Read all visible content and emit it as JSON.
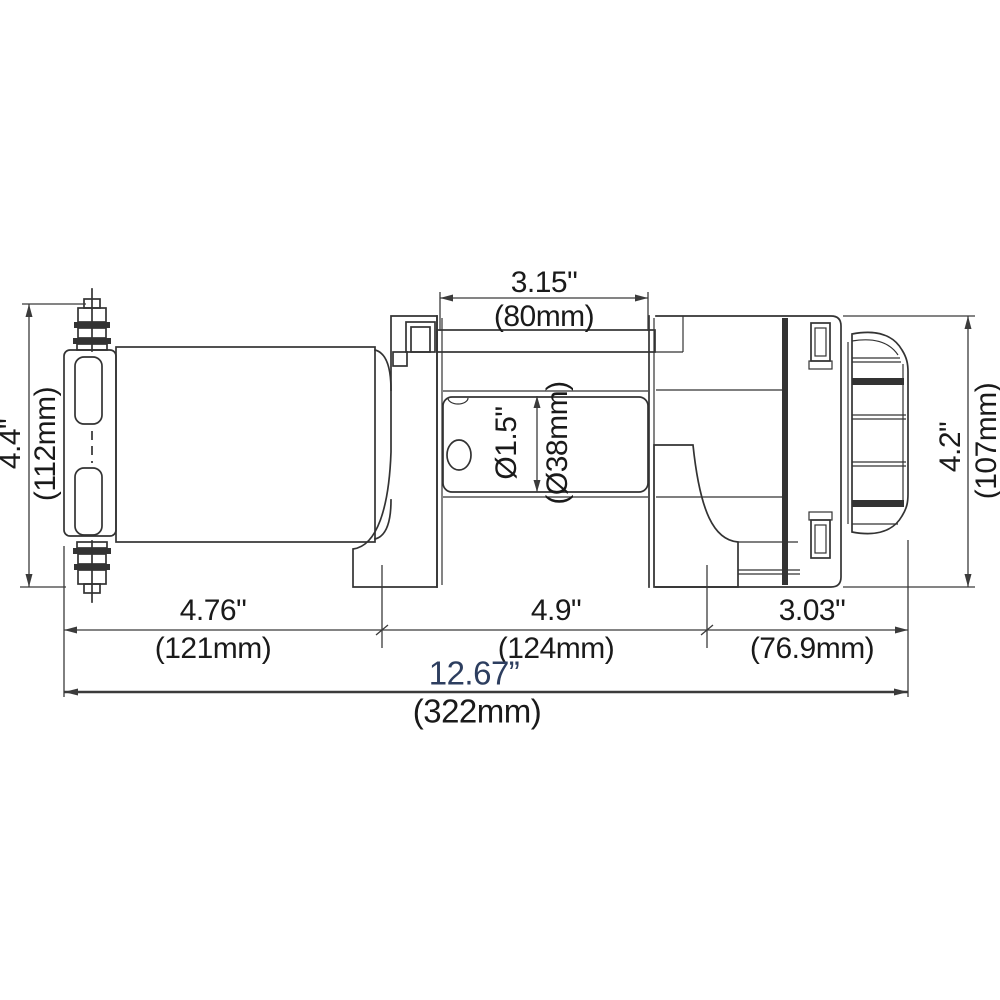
{
  "drawing": {
    "type": "technical-dimension-diagram",
    "subject": "electric winch side elevation",
    "dimensions": {
      "drum_width": {
        "in": "3.15\"",
        "mm": "(80mm)"
      },
      "left_height": {
        "in": "4.4\"",
        "mm": "(112mm)"
      },
      "right_height": {
        "in": "4.2\"",
        "mm": "(107mm)"
      },
      "drum_diameter": {
        "in": "Ø1.5\"",
        "mm": "(Ø38mm)"
      },
      "motor_section": {
        "in": "4.76\"",
        "mm": "(121mm)"
      },
      "drum_section": {
        "in": "4.9\"",
        "mm": "(124mm)"
      },
      "gear_section": {
        "in": "3.03\"",
        "mm": "(76.9mm)"
      },
      "overall_length": {
        "in": "12.67”",
        "mm": "(322mm)"
      }
    },
    "colors": {
      "line": "#333333",
      "text": "#1a1a1a",
      "overall_text": "#2d3e5f",
      "background": "#ffffff"
    }
  }
}
